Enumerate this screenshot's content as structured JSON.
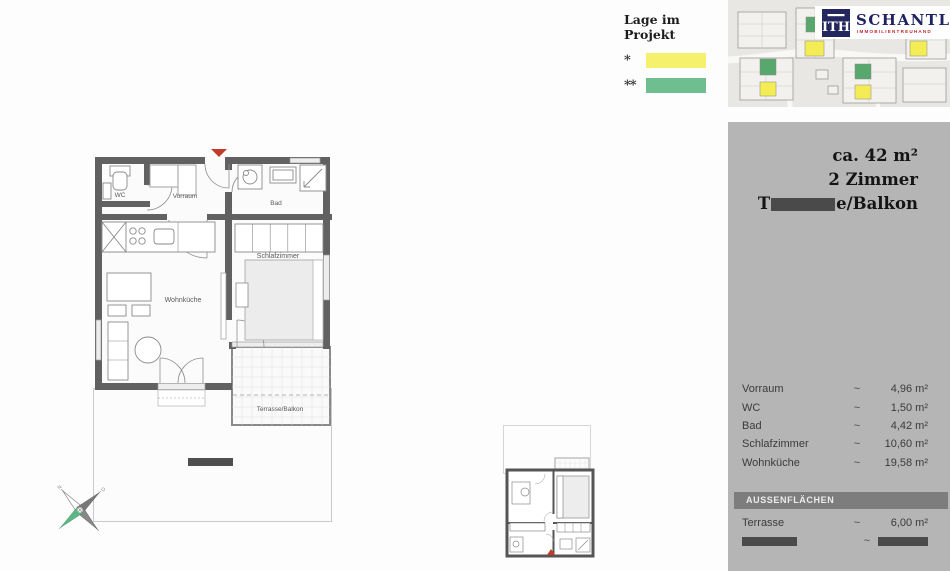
{
  "legend": {
    "title": "Lage im Projekt",
    "items": [
      {
        "mark": "*",
        "swatch_color": "#f6f16c"
      },
      {
        "mark": "**",
        "swatch_color": "#6fbe90"
      }
    ]
  },
  "brand": {
    "monogram": "ITH",
    "name": "SCHANTL",
    "tagline": "IMMOBILIENTREUHAND",
    "navy_color": "#23265f",
    "red_color": "#c0272d"
  },
  "floorplan": {
    "entrance_arrow_color": "#c23b2a",
    "highlight_yellow": "#f6f16c",
    "highlight_green": "#6fbe90",
    "labels": {
      "wc": "WC",
      "vorraum": "Vorraum",
      "bad": "Bad",
      "schlafzimmer": "Schlafzimmer",
      "wohnkueche": "Wohnküche",
      "terrasse": "Terrasse/Balkon"
    }
  },
  "details_panel": {
    "background_color": "#b5b5b5",
    "area_total": "ca. 42 m²",
    "rooms_count": "2 Zimmer",
    "outdoor_title_prefix": "T",
    "outdoor_title_suffix": "e/Balkon",
    "rows": [
      {
        "label": "Vorraum",
        "approx": "~",
        "value": "4,96 m²"
      },
      {
        "label": "WC",
        "approx": "~",
        "value": "1,50 m²"
      },
      {
        "label": "Bad",
        "approx": "~",
        "value": "4,42 m²"
      },
      {
        "label": "Schlafzimmer",
        "approx": "~",
        "value": "10,60 m²"
      },
      {
        "label": "Wohnküche",
        "approx": "~",
        "value": "19,58 m²"
      }
    ],
    "outdoor_header": "AUSSENFLÄCHEN",
    "outdoor_rows": [
      {
        "label": "Terrasse",
        "approx": "~",
        "value": "6,00 m²"
      }
    ],
    "redacted_row_approx": "~"
  }
}
